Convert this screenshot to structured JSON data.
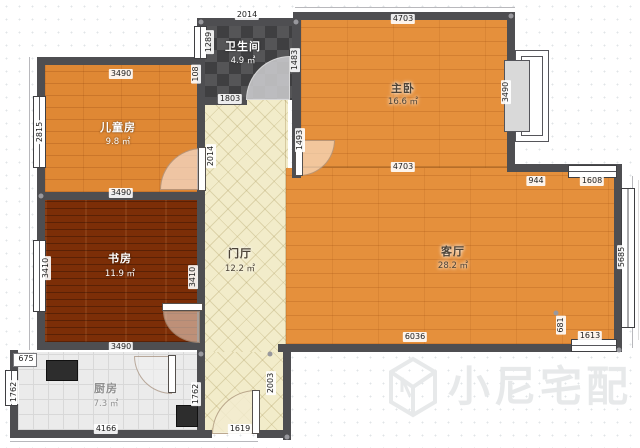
{
  "watermark": {
    "text": "小尼宅配",
    "logo": "cube-logo",
    "color": "#e7e9ea"
  },
  "rooms": {
    "children": {
      "name": "儿童房",
      "area": "9.8 ㎡"
    },
    "bathroom": {
      "name": "卫生间",
      "area": "4.9 ㎡"
    },
    "master": {
      "name": "主卧",
      "area": "16.6 ㎡"
    },
    "hall": {
      "name": "门厅",
      "area": "12.2 ㎡"
    },
    "study": {
      "name": "书房",
      "area": "11.9 ㎡"
    },
    "living": {
      "name": "客厅",
      "area": "28.2 ㎡"
    },
    "kitchen": {
      "name": "厨房",
      "area": "7.3 ㎡"
    }
  },
  "dims": {
    "children_top": "3490",
    "children_left": "2815",
    "children_bottom": "3490",
    "bath_top": "2014",
    "bath_window": "1289",
    "bath_jog": "108",
    "bath_bottom": "1803",
    "bath_right": "1483",
    "master_top": "4703",
    "master_bottom": "4703",
    "master_bay": "3490",
    "hall_vertical": "2014",
    "hall_master_wall": "1493",
    "hall_lower_right": "2003",
    "study_left": "3410",
    "study_right": "3410",
    "study_bottom": "3490",
    "kitchen_flue": "675",
    "kitchen_left": "1762",
    "kitchen_bottom": "4166",
    "kitchen_door_side": "1762",
    "entry_bottom": "1619",
    "living_bottom": "6036",
    "living_right": "5685",
    "living_corner": "681",
    "living_bottom_window": "1613",
    "living_top_segment": "944",
    "living_top_window": "1608"
  },
  "colors": {
    "wood_floor": "#e5903c",
    "dark_wood_floor": "#7c2e07",
    "bath_tile": "#4a4a4c",
    "hall_tile": "#f2ecca",
    "kitchen_tile": "#ebebeb",
    "wall": "#4e4e51",
    "watermark": "#e7e9ea"
  }
}
